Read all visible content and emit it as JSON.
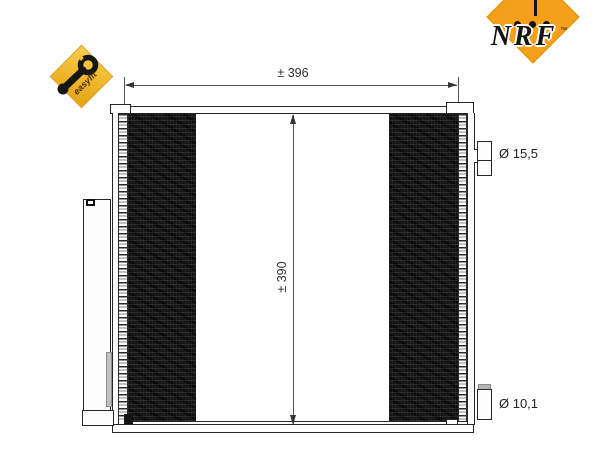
{
  "branding": {
    "nrf": {
      "text": "NRF",
      "trademark": "™",
      "diamond_color": "#F5A01A",
      "text_color": "#151515",
      "dots": 3
    },
    "easyfit": {
      "label": "easyfit",
      "badge_color": "#EEB52B",
      "icon": "wrench-icon"
    }
  },
  "drawing": {
    "dimensions": {
      "width": "± 396",
      "height": "± 390"
    },
    "ports": {
      "top_diameter": "Ø 15,5",
      "bottom_diameter": "Ø 10,1"
    },
    "colors": {
      "line": "#262626",
      "core_fill": "#151515",
      "dimension_line": "#555555"
    }
  }
}
